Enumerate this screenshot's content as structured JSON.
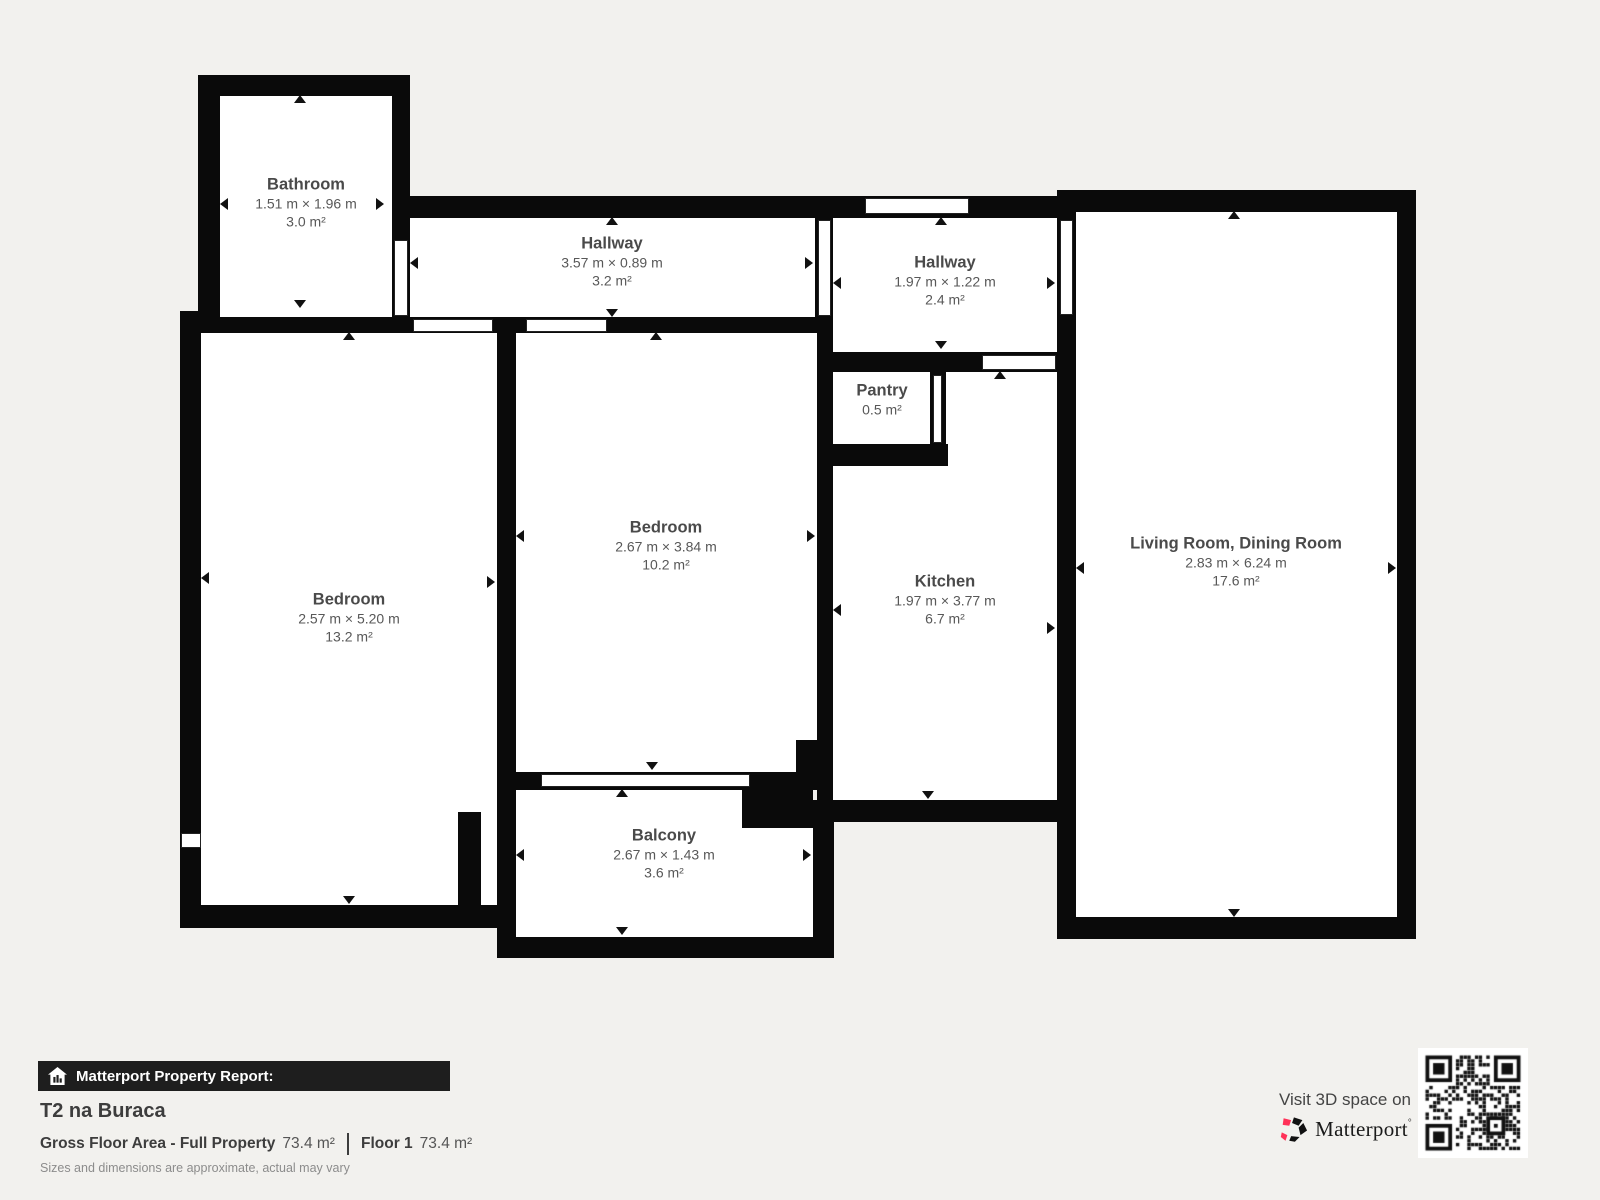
{
  "rooms": [
    {
      "name": "Bathroom",
      "dims": "1.51 m × 1.96 m",
      "area": "3.0 m²"
    },
    {
      "name": "Hallway",
      "dims": "3.57 m × 0.89 m",
      "area": "3.2 m²"
    },
    {
      "name": "Hallway",
      "dims": "1.97 m × 1.22 m",
      "area": "2.4 m²"
    },
    {
      "name": "Pantry",
      "dims": "",
      "area": "0.5 m²"
    },
    {
      "name": "Kitchen",
      "dims": "1.97 m × 3.77 m",
      "area": "6.7 m²"
    },
    {
      "name": "Living Room, Dining Room",
      "dims": "2.83 m × 6.24 m",
      "area": "17.6 m²"
    },
    {
      "name": "Bedroom",
      "dims": "2.57 m × 5.20 m",
      "area": "13.2 m²"
    },
    {
      "name": "Bedroom",
      "dims": "2.67 m × 3.84 m",
      "area": "10.2 m²"
    },
    {
      "name": "Balcony",
      "dims": "2.67 m × 1.43 m",
      "area": "3.6 m²"
    }
  ],
  "footer": {
    "report_label": "Matterport Property Report:",
    "property_name": "T2 na Buraca",
    "gfa_label": "Gross Floor Area - Full Property",
    "gfa_value": "73.4 m²",
    "floor_label": "Floor 1",
    "floor_value": "73.4 m²",
    "disclaimer": "Sizes and dimensions are approximate, actual may vary",
    "visit_label": "Visit 3D space on",
    "brand": "Matterport",
    "brand_tm": "°"
  },
  "icons": {
    "banner_icon": "house-report-icon",
    "brand_icon": "matterport-pinwheel-icon",
    "qr": "qr-code",
    "measure_arrows": "measure-arrow-icons"
  },
  "colors": {
    "background": "#f2f1ee",
    "wall": "#0a0a0a",
    "room_fill": "#ffffff",
    "label_text": "#4a4a4a",
    "banner_bg": "#1e1e1e",
    "brand_pink": "#ff3158"
  }
}
